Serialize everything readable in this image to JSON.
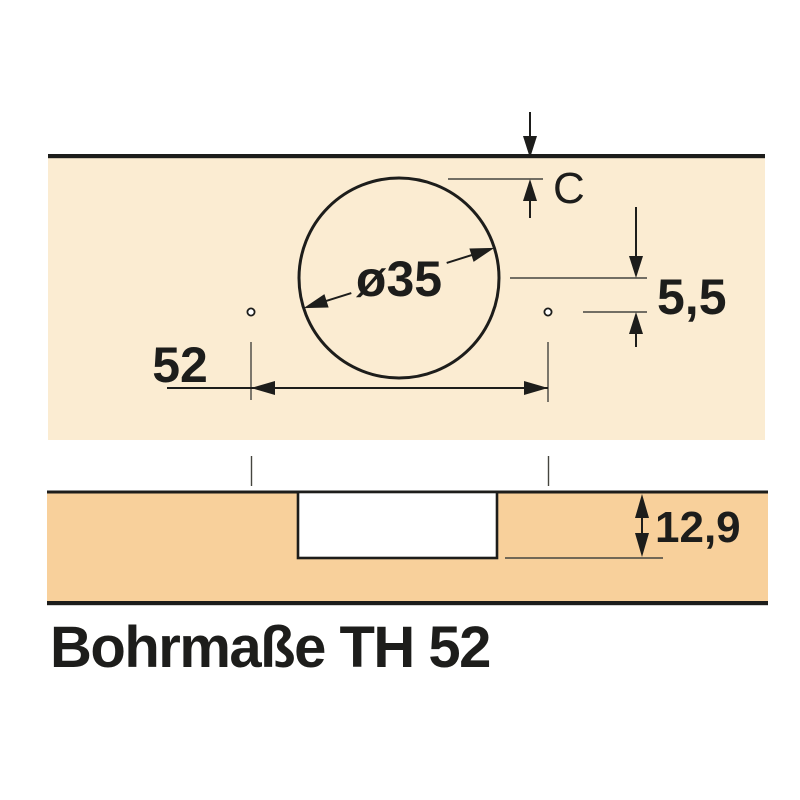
{
  "title": "Bohrmaße TH 52",
  "dimensions": {
    "cup_diameter": "ø35",
    "cup_edge_distance": "C",
    "cup_center_to_screw_holes": "5,5",
    "screw_hole_spacing": "52",
    "drill_depth": "12,9"
  },
  "colors": {
    "panel_face_fill": "#FBECD2",
    "panel_section_fill": "#F8D09B",
    "hole_fill": "#FFFFFF",
    "line": "#1D1D1B"
  }
}
